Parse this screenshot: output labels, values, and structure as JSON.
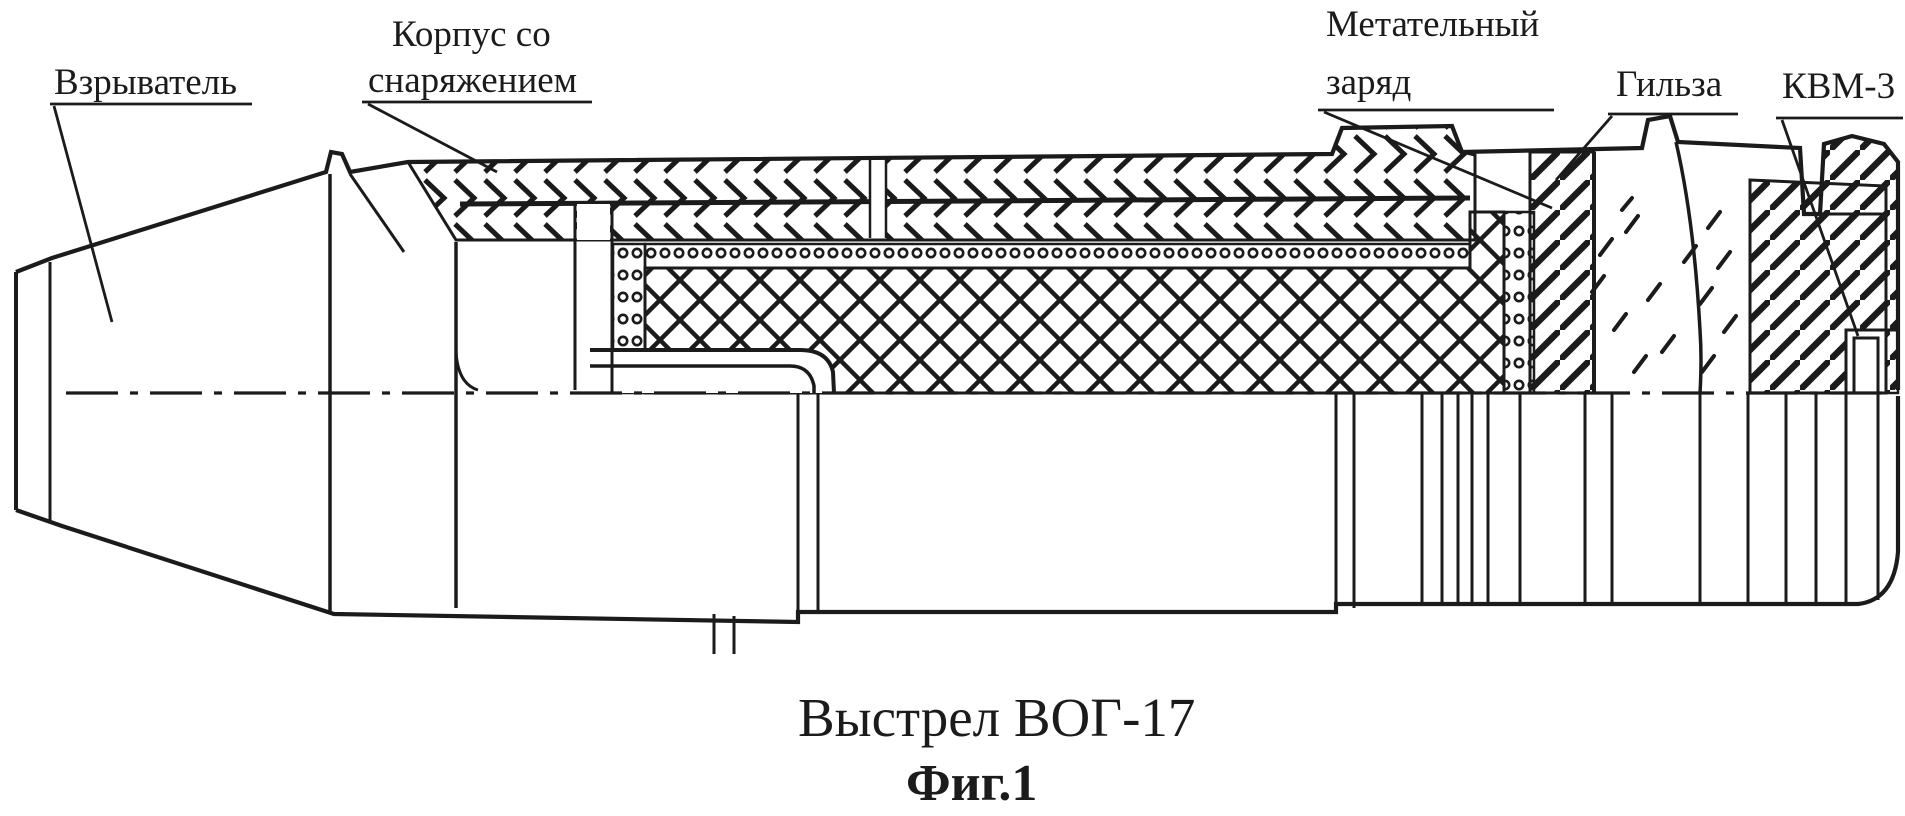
{
  "figure": {
    "caption": "Выстрел ВОГ-17",
    "figure_number": "Фиг.1"
  },
  "labels": {
    "fuze": "Взрыватель",
    "body_line1": "Корпус со",
    "body_line2": "снаряжением",
    "propellant_line1": "Метательный",
    "propellant_line2": "заряд",
    "case": "Гильза",
    "primer": "КВМ-3"
  },
  "colors": {
    "ink": "#1b1b1b",
    "paper": "#ffffff"
  }
}
